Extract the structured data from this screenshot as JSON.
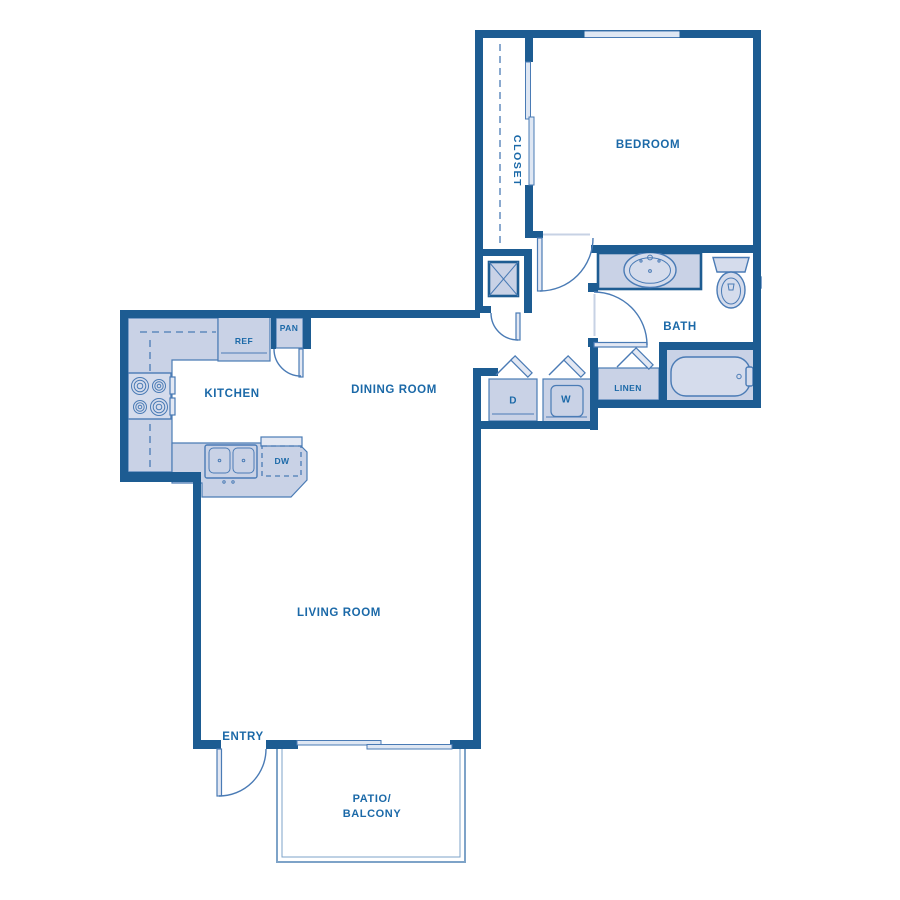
{
  "colors": {
    "wall": "#1d5c92",
    "fill": "#c9d2e6",
    "fixfill": "#d5dcec",
    "leaffill": "#e3e8f3",
    "winfill": "#dfe7f3",
    "line": "#4a7bb5",
    "label": "#1b69a8",
    "patio": "#7ea3c8"
  },
  "labels": {
    "bedroom": "BEDROOM",
    "closet": "CLOSET",
    "bath": "BATH",
    "linen": "LINEN",
    "kitchen": "KITCHEN",
    "dining_room": "DINING ROOM",
    "living_room": "LIVING ROOM",
    "entry": "ENTRY",
    "patio_line1": "PATIO/",
    "patio_line2": "BALCONY",
    "ref": "REF",
    "pan": "PAN",
    "dw": "DW",
    "dryer": "D",
    "washer": "W"
  }
}
